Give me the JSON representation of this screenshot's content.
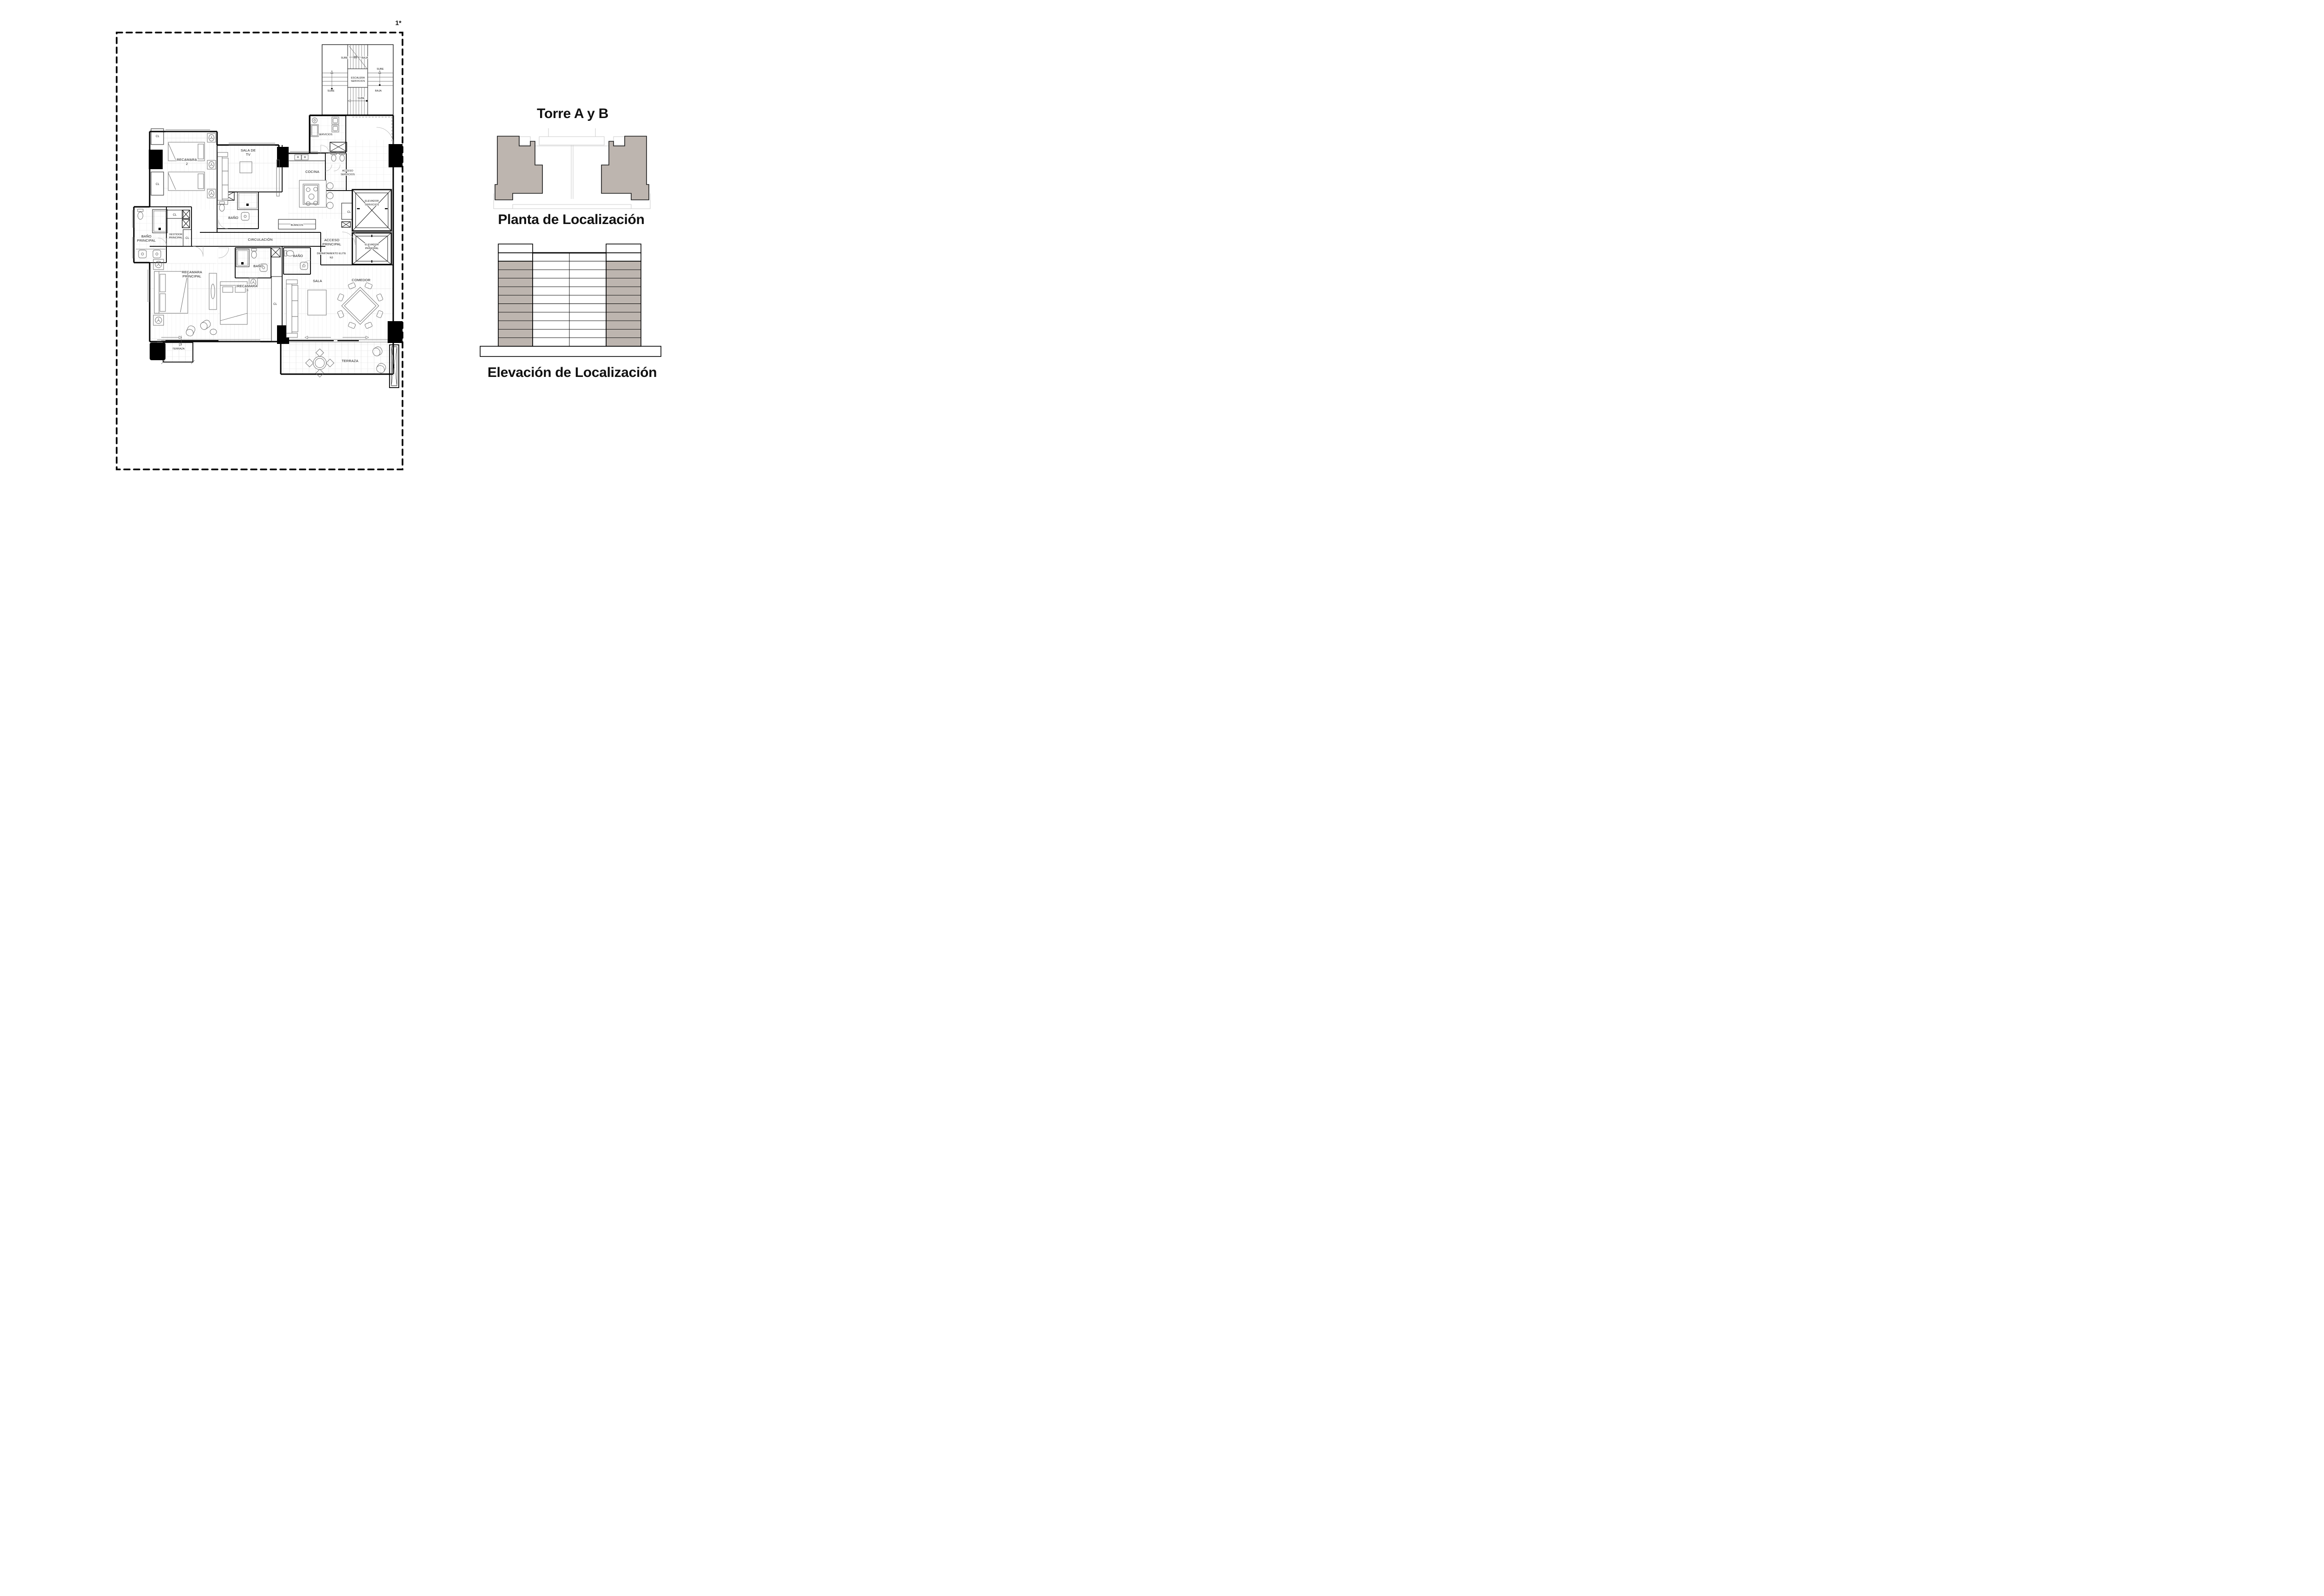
{
  "sheet": {
    "number": "1*"
  },
  "colors": {
    "tower_fill": "#bdb5af",
    "line": "#000000"
  },
  "plan": {
    "stair": {
      "label": [
        "ESCALERA",
        "SERVICIOS"
      ],
      "sube": "SUBE",
      "baja": "BAJA"
    },
    "rooms": {
      "servicios": "SERVICIOS",
      "acceso_servicios": [
        "ACCESO",
        "SERVICIOS"
      ],
      "cocina": "COCINA",
      "sala_tv": [
        "SALA DE",
        "TV"
      ],
      "recamara2": [
        "RECAMARA",
        "2"
      ],
      "bano": "BAÑO",
      "bano_principal": [
        "BAÑO",
        "PRINCIPAL"
      ],
      "vestidor": [
        "VESTIDOR",
        "PRINCIPAL"
      ],
      "circulacion": "CIRCULACIÓN",
      "blancos": "BLANCOS",
      "elevador_servicios": [
        "ELEVADOR",
        "SERVICIOS"
      ],
      "elevador_principal": [
        "ELEVADOR",
        "PRINCIPAL"
      ],
      "acceso_principal": [
        "ACCESO",
        "PRINCIPAL"
      ],
      "departamento": "DEPARTAMENTO ELITE",
      "nivel": "N3",
      "recamara_principal": [
        "RECAMARA",
        "PRINCIPAL"
      ],
      "recamara3": [
        "RECAMARA",
        "3"
      ],
      "sala": "SALA",
      "comedor": "COMEDOR",
      "terraza": "TERRAZA",
      "closet": "CL"
    }
  },
  "panel": {
    "title": "Torre A y B",
    "plan_caption": "Planta de Localización",
    "elevation_caption": "Elevación de Localización"
  }
}
